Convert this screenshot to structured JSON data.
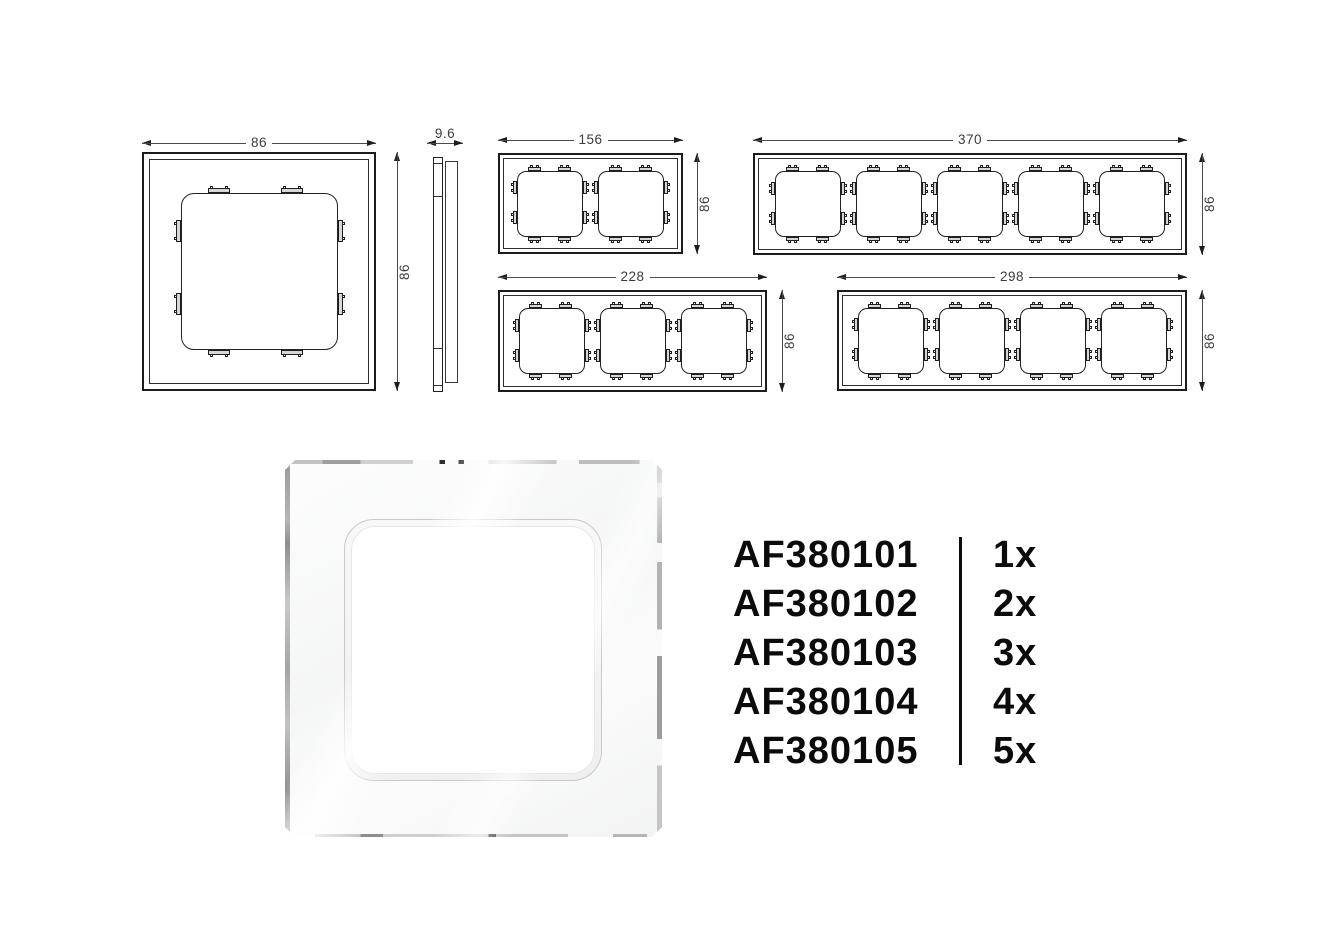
{
  "dimensions": {
    "single": {
      "width": "86",
      "height": "86"
    },
    "side": {
      "depth": "9.6"
    },
    "gang2": {
      "width": "156",
      "height": "86"
    },
    "gang3": {
      "width": "228",
      "height": "86"
    },
    "gang4": {
      "width": "298",
      "height": "86"
    },
    "gang5": {
      "width": "370",
      "height": "86"
    }
  },
  "products": {
    "rows": [
      {
        "code": "AF380101",
        "qty": "1x"
      },
      {
        "code": "AF380102",
        "qty": "2x"
      },
      {
        "code": "AF380103",
        "qty": "3x"
      },
      {
        "code": "AF380104",
        "qty": "4x"
      },
      {
        "code": "AF380105",
        "qty": "5x"
      }
    ]
  },
  "colors": {
    "drawing_line": "#2a2a2a",
    "dimension_text": "#3c3c3c",
    "list_text": "#0b0b0b",
    "glass_edge": "#a8a8a8"
  }
}
